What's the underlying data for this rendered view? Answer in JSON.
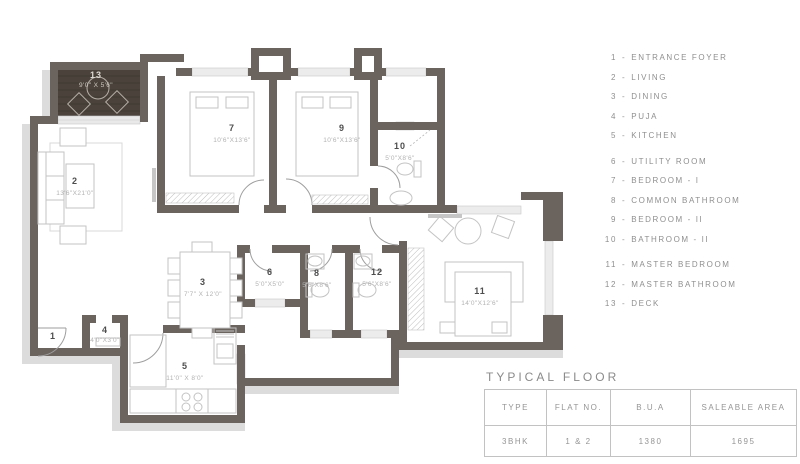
{
  "colors": {
    "wall": "#6b635d",
    "deck_floor": "#4a423b",
    "drop_shadow": "#dcdcdc",
    "window_band": "#ececec",
    "text_gray": "#8f8f8f"
  },
  "plan": {
    "rooms": [
      {
        "num": "1",
        "name": "ENTRANCE FOYER",
        "dims": ""
      },
      {
        "num": "2",
        "name": "LIVING",
        "dims": "13'6\"X21'0\""
      },
      {
        "num": "3",
        "name": "DINING",
        "dims": "7'7\" X 12'0\""
      },
      {
        "num": "4",
        "name": "PUJA",
        "dims": "4'0\"X3'0\""
      },
      {
        "num": "5",
        "name": "KITCHEN",
        "dims": "11'0\" X 8'0\""
      },
      {
        "num": "6",
        "name": "UTILITY ROOM",
        "dims": "5'0\"X5'0\""
      },
      {
        "num": "7",
        "name": "BEDROOM - I",
        "dims": "10'6\"X13'6\""
      },
      {
        "num": "8",
        "name": "COMMON BATHROOM",
        "dims": "5'6\"X8'6\""
      },
      {
        "num": "9",
        "name": "BEDROOM - II",
        "dims": "10'6\"X13'6\""
      },
      {
        "num": "10",
        "name": "BATHROOM - II",
        "dims": "5'0\"X8'6\""
      },
      {
        "num": "11",
        "name": "MASTER BEDROOM",
        "dims": "14'0\"X12'6\""
      },
      {
        "num": "12",
        "name": "MASTER BATHROOM",
        "dims": "5'6\"X8'6\""
      },
      {
        "num": "13",
        "name": "DECK",
        "dims": "9'0\" X 5'6\""
      }
    ]
  },
  "legend": {
    "separator": "-",
    "items": [
      {
        "n": "1",
        "label": "ENTRANCE FOYER"
      },
      {
        "n": "2",
        "label": "LIVING"
      },
      {
        "n": "3",
        "label": "DINING"
      },
      {
        "n": "4",
        "label": "PUJA"
      },
      {
        "n": "5",
        "label": "KITCHEN"
      },
      {
        "n": "6",
        "label": "UTILITY ROOM"
      },
      {
        "n": "7",
        "label": "BEDROOM - I"
      },
      {
        "n": "8",
        "label": "COMMON BATHROOM"
      },
      {
        "n": "9",
        "label": "BEDROOM - II"
      },
      {
        "n": "10",
        "label": "BATHROOM - II"
      },
      {
        "n": "11",
        "label": "MASTER BEDROOM"
      },
      {
        "n": "12",
        "label": "MASTER BATHROOM"
      },
      {
        "n": "13",
        "label": "DECK"
      }
    ]
  },
  "table": {
    "title": "TYPICAL FLOOR",
    "headers": [
      "TYPE",
      "FLAT NO.",
      "B.U.A",
      "SALEABLE AREA"
    ],
    "rows": [
      [
        "3BHK",
        "1 & 2",
        "1380",
        "1695"
      ]
    ]
  }
}
